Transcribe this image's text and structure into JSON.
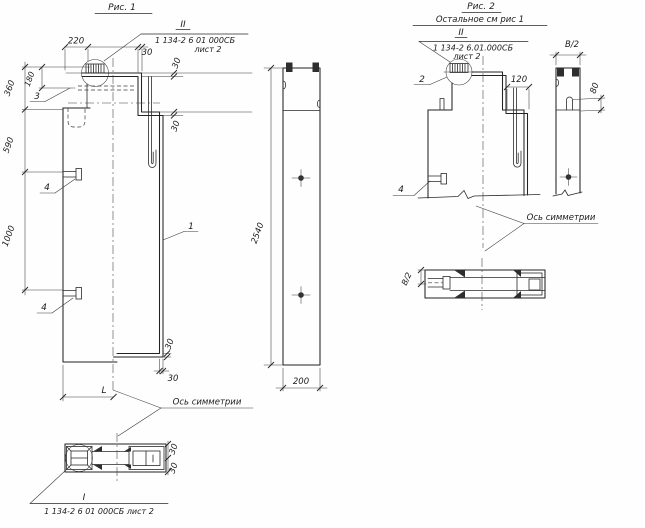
{
  "fig1": {
    "title": "Рис. 1",
    "callout_top_mark": "II",
    "callout_top_doc": "1 134-2 6 01 000СБ",
    "callout_top_sheet": "лист 2",
    "callout_bottom_mark": "I",
    "callout_bottom_doc": "1 134-2 6 01 000СБ лист 2",
    "axis_label": "Ось симметрии",
    "leader_1": "1",
    "leader_3": "3",
    "leader_4a": "4",
    "leader_4b": "4",
    "dim_220": "220",
    "dim_30_top": "30",
    "dim_30_plate": "30",
    "dim_30_step": "30",
    "dim_360": "360",
    "dim_180": "180",
    "dim_590": "590",
    "dim_1000": "1000",
    "dim_30_flange": "30",
    "dim_30_wall": "30",
    "dim_L": "L",
    "dim_30_plan_top": "30",
    "dim_30_plan_bottom": "30"
  },
  "side": {
    "dim_2540": "2540",
    "dim_200": "200"
  },
  "fig2": {
    "title": "Рис. 2",
    "subtitle": "Остальное см рис 1",
    "callout_top_mark": "II",
    "callout_top_doc": "1 134-2 6.01.000СБ",
    "callout_top_sheet": "лист 2",
    "axis_label": "Ось симметрии",
    "leader_2": "2",
    "leader_4": "4",
    "dim_120": "120",
    "dim_b2_section": "В/2",
    "dim_80": "80",
    "dim_b2_plan": "В/2"
  }
}
